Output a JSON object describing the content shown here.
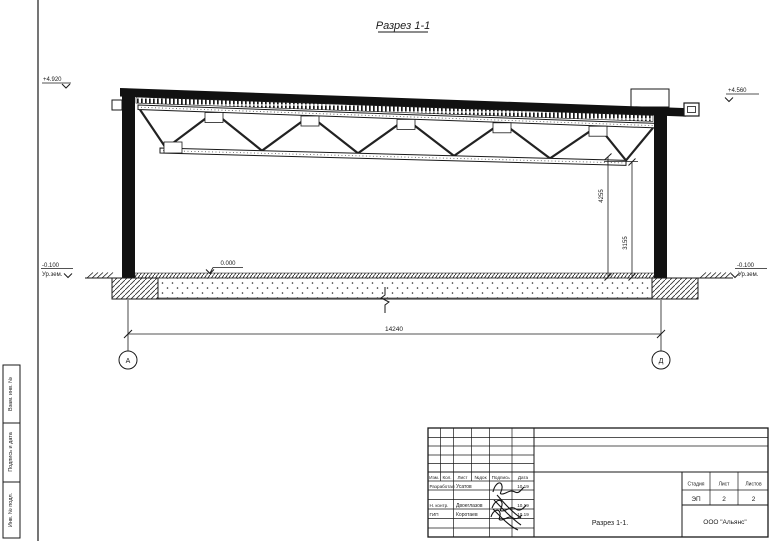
{
  "sheet": {
    "title": "Разрез 1-1",
    "margin_labels": [
      "Взам. инв. №",
      "Подпись и дата",
      "Инв. № подл."
    ]
  },
  "drawing": {
    "elevations": {
      "top_left": "+4.920",
      "top_right": "+4.560",
      "floor": "0.000",
      "ground": {
        "value": "-0.100",
        "sub": "Ур.зем."
      }
    },
    "dimensions": {
      "span": "14240",
      "height_truss_top": "4255",
      "height_truss_bottom": "3155"
    },
    "axes": {
      "left": "А",
      "right": "Д"
    }
  },
  "title_block": {
    "header_cols": [
      "Изм.",
      "Кол.",
      "Лист",
      "№док",
      "Подпись",
      "Дата"
    ],
    "rows": [
      {
        "role": "Разработал",
        "name": "Усатов",
        "date": "10.19"
      },
      {
        "role": "Н. контр.",
        "name": "Двоеглазов",
        "date": "10.19"
      },
      {
        "role": "ГИП",
        "name": "Коротаев",
        "date": "10.19"
      }
    ],
    "stage_label": "Стадия",
    "sheet_label": "Лист",
    "sheets_label": "Листов",
    "stage": "ЭП",
    "sheet_no": "2",
    "sheets_total": "2",
    "doc_name": "Разрез 1-1.",
    "company": "ООО \"Альянс\""
  }
}
